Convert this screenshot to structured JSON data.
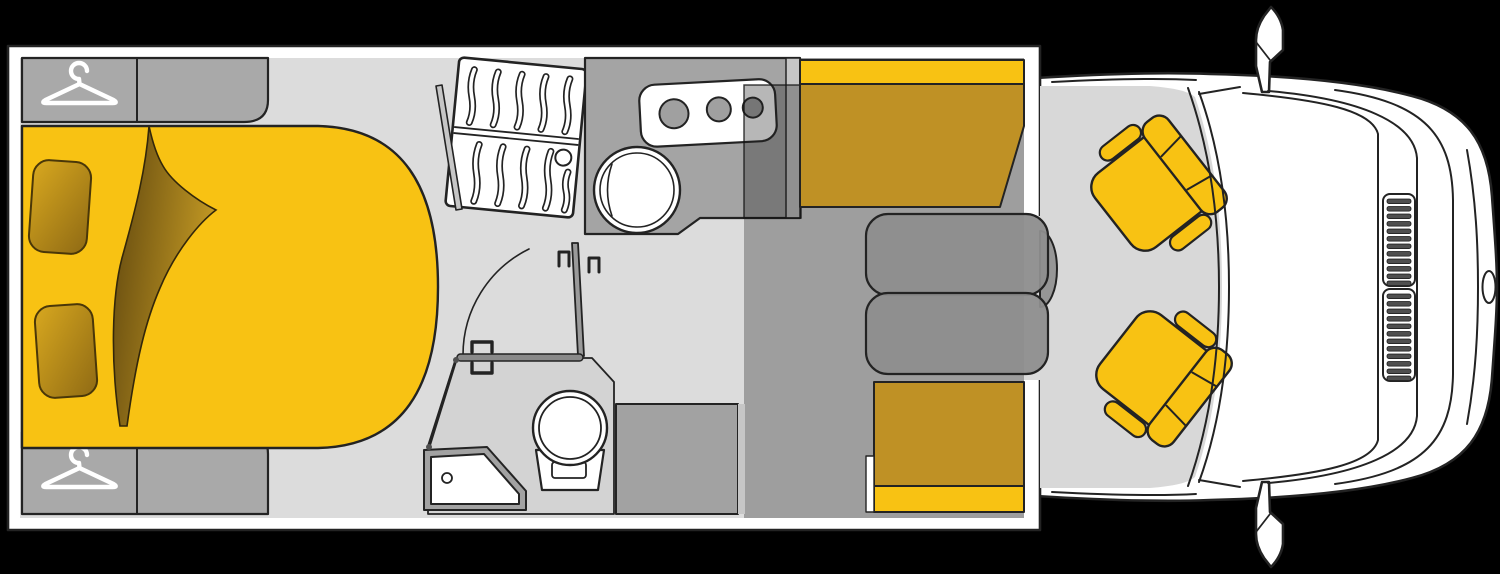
{
  "colors": {
    "bg": "#000000",
    "line": "#232323",
    "vehicle_white": "#ffffff",
    "wall_white": "#ffffff",
    "floor_light": "#dcdcdc",
    "floor_cab": "#d8d8d8",
    "floor_dinette": "#9e9e9e",
    "floor_bath": "#d3d3d3",
    "furniture_gray": "#a9a9a9",
    "counter_gray": "#a4a4a4",
    "cabinet_dark": "#a2a2a2",
    "wall_strip": "#c6c6c6",
    "table_gray": "#8e8e8e",
    "overlay_dark": "rgba(30,30,30,0.32)",
    "yellow_bright": "#f8c213",
    "gold_dark": "#bf9125",
    "fold_dark": "#5e450e",
    "fold_light": "#c49a24",
    "pillow_light": "#d8a81f",
    "pillow_dark": "#8f6a14",
    "burner_gray": "#a0a0a0",
    "grille_slat": "#4f4f4f",
    "bar_gray": "#8a8a8a",
    "door_gray": "#9a9a9a",
    "steer_gray": "#969696"
  },
  "icons": {
    "wardrobe_front": "hanger-icon",
    "wardrobe_rear": "hanger-icon"
  },
  "components": [
    "double-bed",
    "pillows",
    "wardrobes",
    "slatted-cabinet",
    "kitchen-counter",
    "stove-3-burner",
    "round-sink",
    "fridge-unit",
    "bathroom",
    "shower-tray",
    "toilet",
    "dinette-table",
    "bench-seats",
    "swivel-cab-seats",
    "vehicle-cab-front"
  ]
}
